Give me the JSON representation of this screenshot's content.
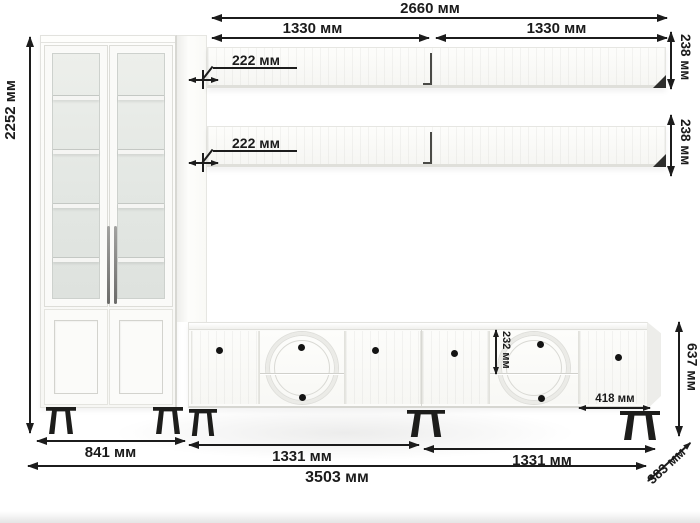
{
  "diagram": {
    "type": "furniture-dimension-drawing",
    "units": "мм",
    "colors": {
      "furniture": "#fbfbf9",
      "glass": "#e4e7e3",
      "legs": "#1d1d1b",
      "dimension_lines": "#1c1c1c",
      "background": "#ffffff"
    }
  },
  "labels": {
    "total_top": "2660 мм",
    "shelf_left_width": "1330 мм",
    "shelf_right_width": "1330 мм",
    "shelf_height_top": "238 мм",
    "shelf_height_bottom": "238 мм",
    "shelf_depth_top": "222 мм",
    "shelf_depth_bottom": "222 мм",
    "cabinet_height": "2252 мм",
    "cabinet_width": "841 мм",
    "stand_left_width": "1331 мм",
    "stand_right_width": "1331 мм",
    "total_width": "3503 мм",
    "stand_depth": "383 мм",
    "stand_height": "637 мм",
    "drawer_height": "232 мм",
    "door_width": "418 мм"
  },
  "components": {
    "cabinet": "display cabinet with two glass doors",
    "shelves": "two wall shelves",
    "stand": "TV stand with doors and drawers"
  }
}
